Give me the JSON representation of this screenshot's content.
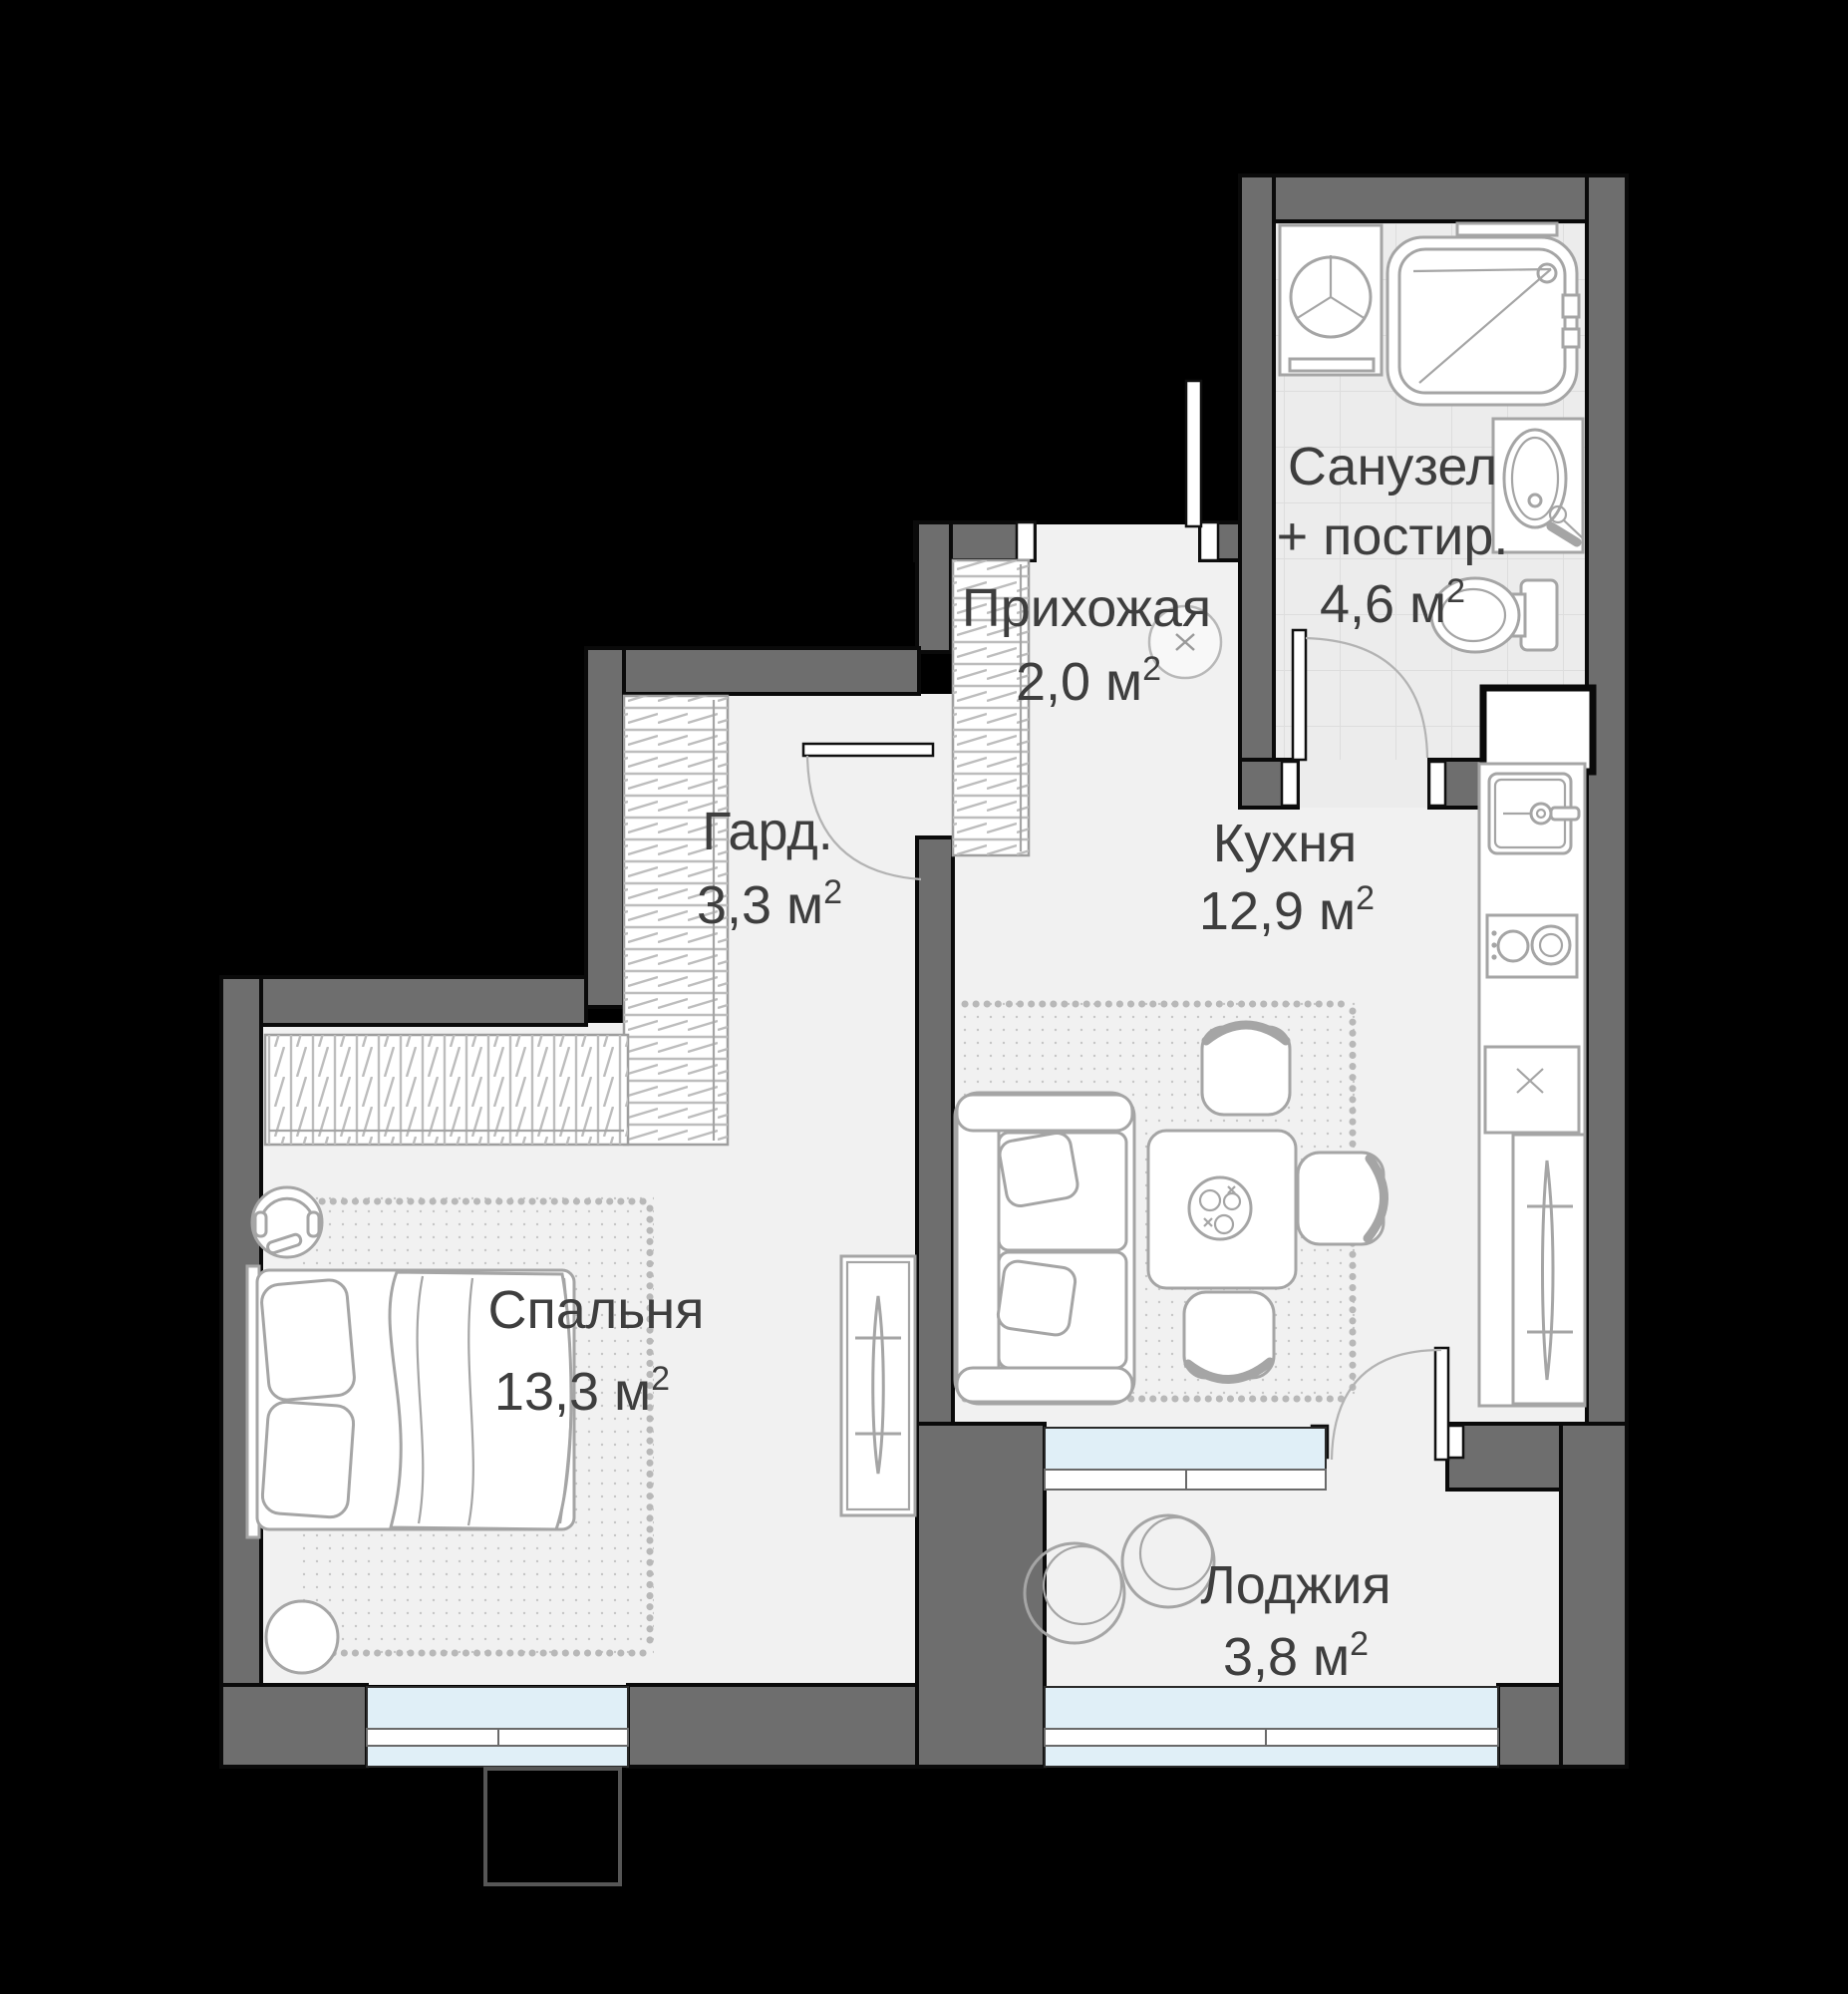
{
  "plan": {
    "type": "apartment-floor-plan",
    "rooms": [
      {
        "id": "hallway",
        "name": "Прихожая",
        "area": "2,0 м",
        "sup": "2"
      },
      {
        "id": "bathroom",
        "name": "Санузел",
        "name2": "+ постир.",
        "area": "4,6 м",
        "sup": "2"
      },
      {
        "id": "wardrobe",
        "name": "Гард.",
        "area": "3,3 м",
        "sup": "2"
      },
      {
        "id": "kitchen",
        "name": "Кухня",
        "area": "12,9 м",
        "sup": "2"
      },
      {
        "id": "bedroom",
        "name": "Спальня",
        "area": "13,3 м",
        "sup": "2"
      },
      {
        "id": "loggia",
        "name": "Лоджия",
        "area": "3,8 м",
        "sup": "2"
      }
    ],
    "icons": [
      "washing-machine-icon",
      "bathtub-icon",
      "sink-icon",
      "toilet-icon",
      "vent-shaft-icon",
      "wardrobe-hatch-icon",
      "ceiling-light-icon",
      "kitchen-sink-icon",
      "cooktop-icon",
      "oven-icon",
      "tall-cabinet-icon",
      "sofa-icon",
      "dining-table-icon",
      "chair-icon",
      "bed-icon",
      "headphones-chair-icon",
      "stool-icon",
      "dresser-icon",
      "round-chair-icon",
      "door-swing-icon",
      "window-icon",
      "balcony-icon"
    ],
    "colors": {
      "outside": "#000000",
      "wall": "#6e6e6e",
      "floor": "#f1f1f1",
      "tile": "#ececec",
      "window_blue": "#e0eff7",
      "window_blue_light": "#eef7fb",
      "furniture": "#a5a5a5",
      "text": "#3e3e3e"
    }
  }
}
